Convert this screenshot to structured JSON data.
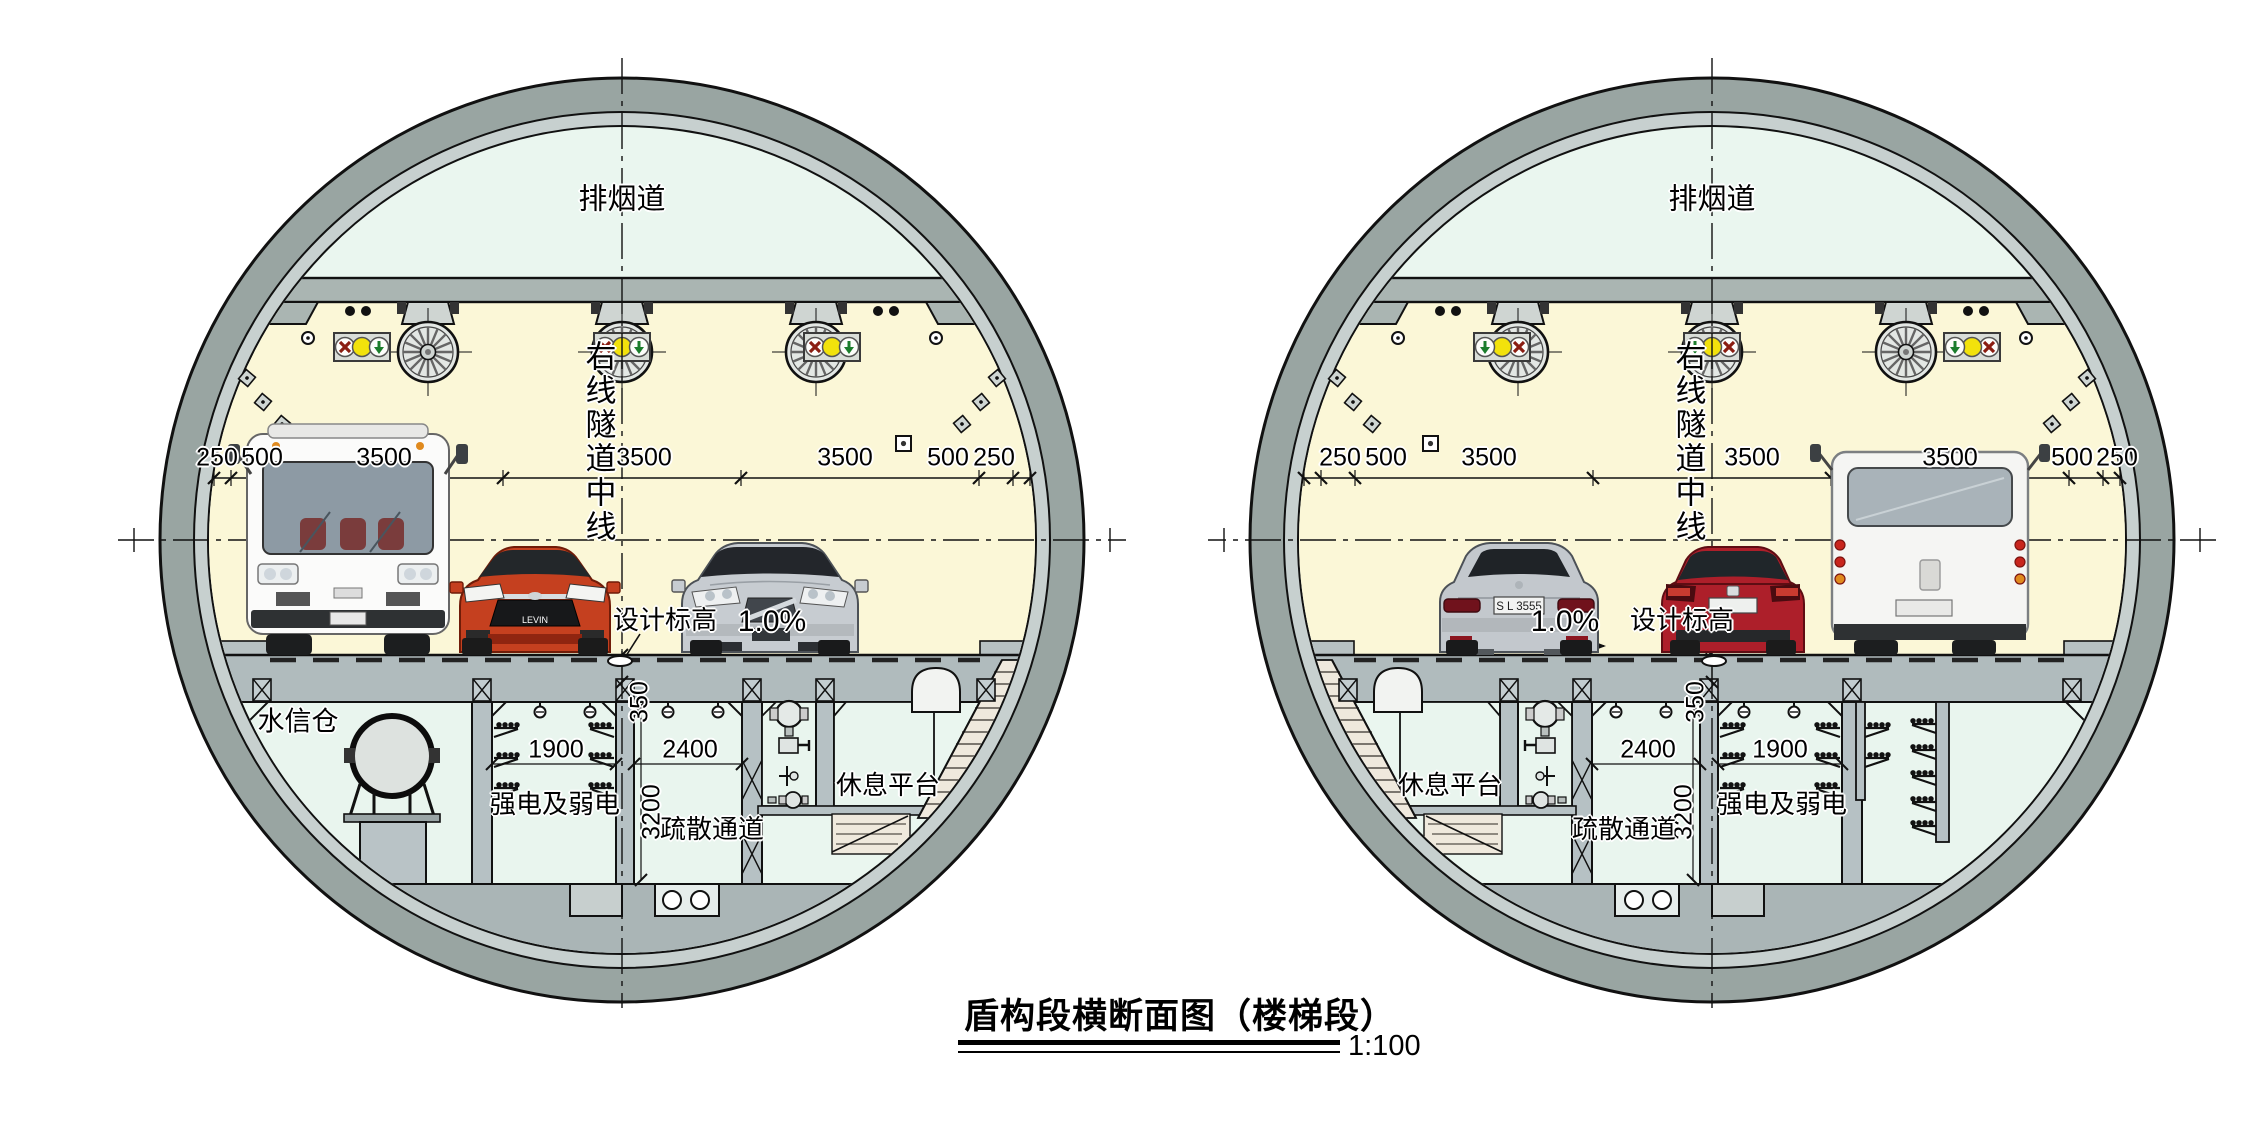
{
  "title_block": {
    "title": "盾构段横断面图（楼梯段）",
    "scale": "1:100"
  },
  "tunnel_labels": {
    "smoke_duct": "排烟道",
    "tunnel_centerline": "右线隧道中线",
    "design_elevation": "设计标高",
    "slope": "1.0%",
    "deck_thickness": "350",
    "power_room": "强电及弱电",
    "power_room_width": "1900",
    "evac_passage": "疏散通道",
    "evac_passage_width": "2400",
    "evac_passage_height": "3200",
    "rest_platform": "休息平台",
    "water_room": "水信仓"
  },
  "lane_dimensions": [
    "250",
    "500",
    "3500",
    "3500",
    "3500",
    "500",
    "250"
  ],
  "vehicles": {
    "red_car_badge": "LEVIN",
    "silver_sedan_plate": "S L 3555"
  },
  "colors": {
    "lining_ring": "#99a5a2",
    "liner_band": "#c7d0cf",
    "smoke_duct_area": "#eaf6ef",
    "carriageway_area": "#fbf7d7",
    "structure_gray": "#b0bbbd",
    "stair_beige": "#efe9dd",
    "signal_red": "#8a1d12",
    "signal_yellow": "#f2e20c",
    "signal_green": "#1c7d2c"
  }
}
